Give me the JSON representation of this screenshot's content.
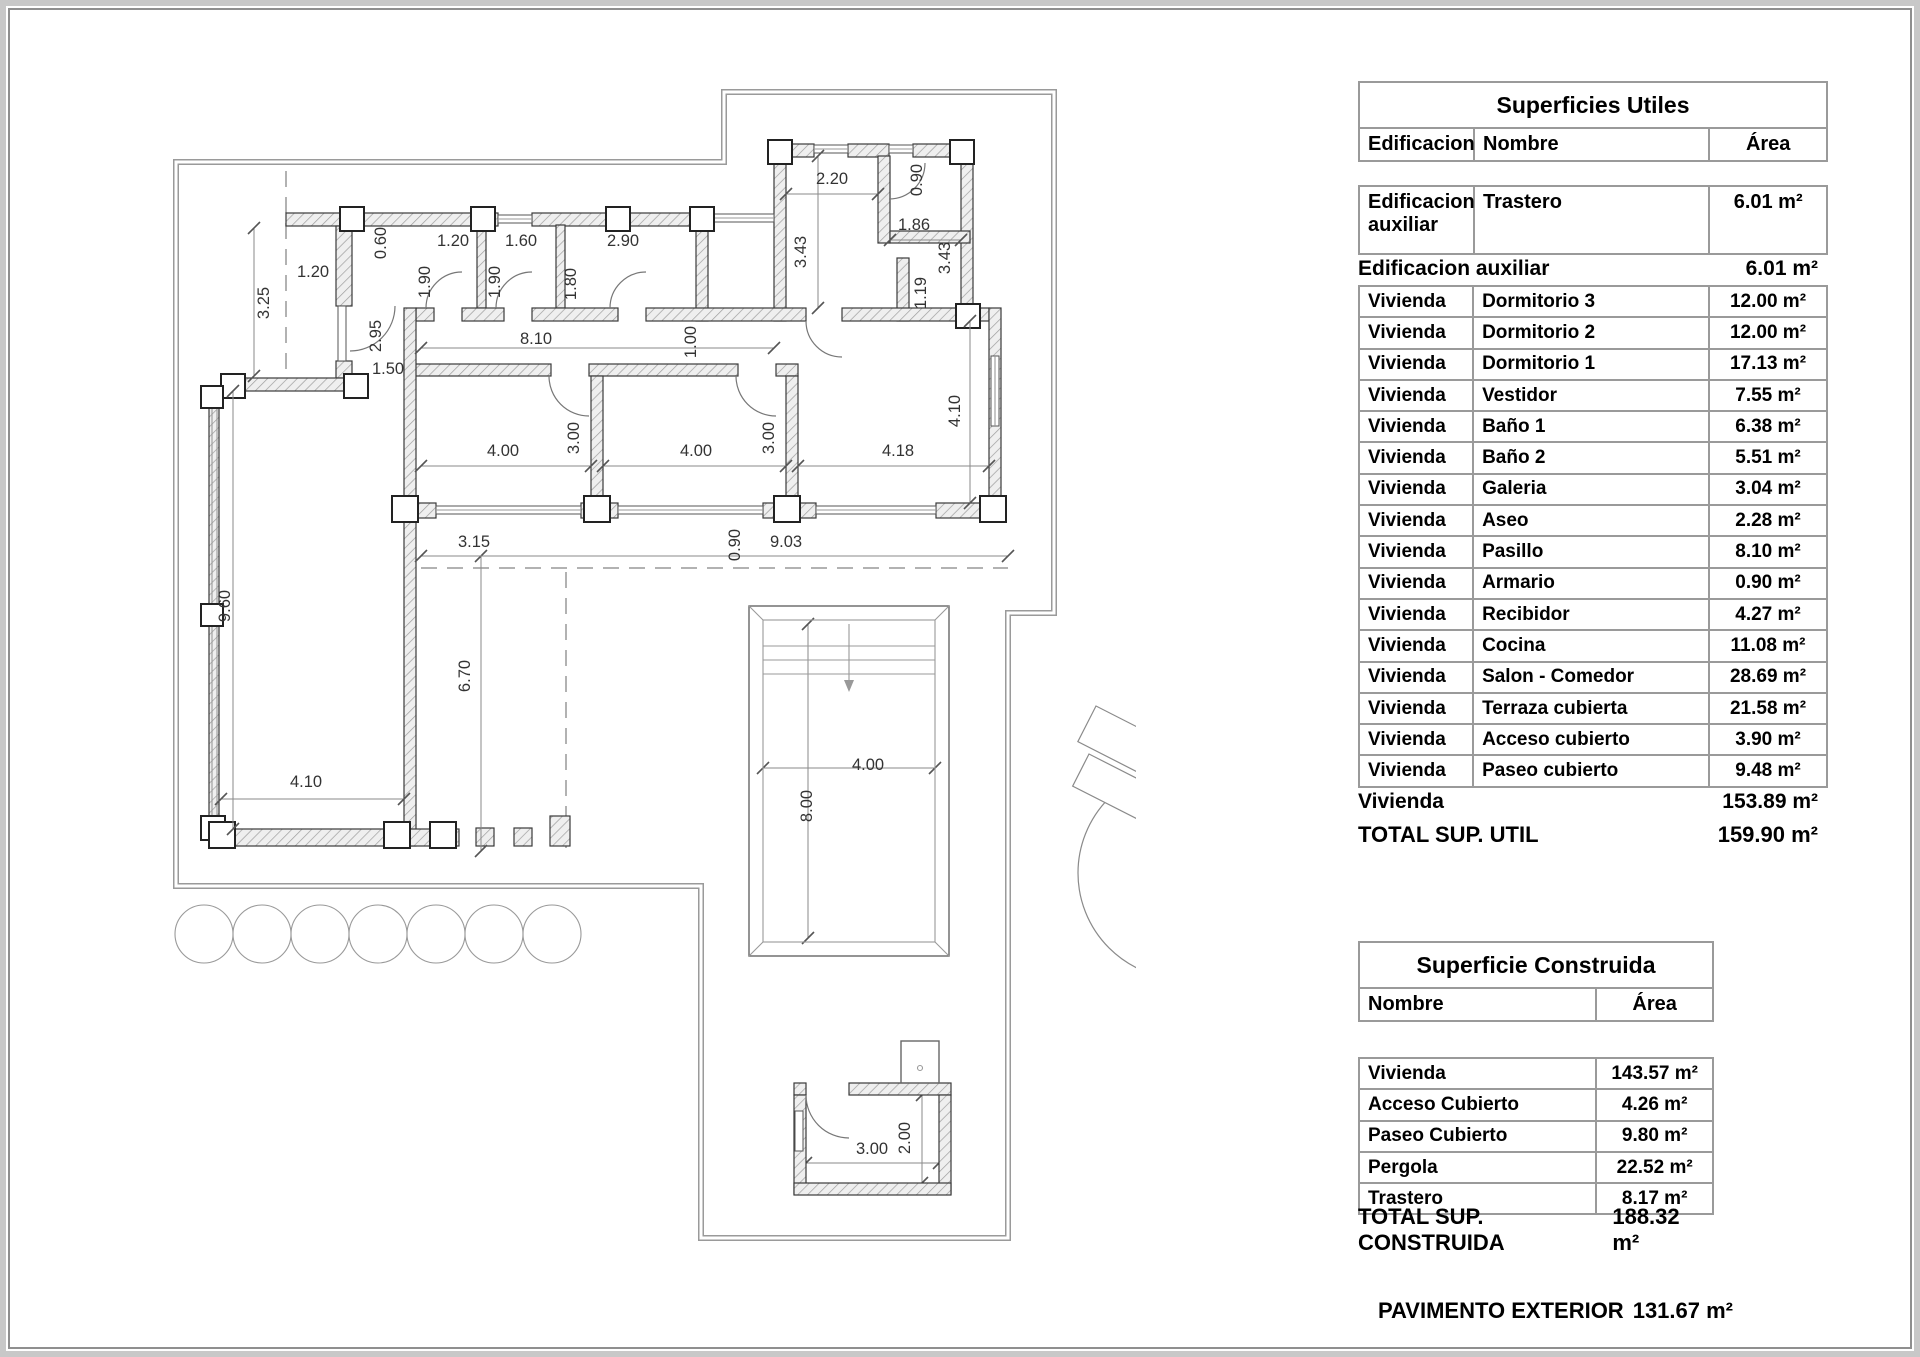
{
  "tables": {
    "utiles": {
      "title": "Superficies Utiles",
      "columns": {
        "edificacion": "Edificacion",
        "nombre": "Nombre",
        "area": "Área"
      },
      "aux_row": {
        "edificacion": "Edificacion auxiliar",
        "nombre": "Trastero",
        "area": "6.01 m²"
      },
      "aux_summary": {
        "label": "Edificacion auxiliar",
        "value": "6.01 m²"
      },
      "rows": [
        {
          "e": "Vivienda",
          "n": "Dormitorio 3",
          "a": "12.00 m²"
        },
        {
          "e": "Vivienda",
          "n": "Dormitorio 2",
          "a": "12.00 m²"
        },
        {
          "e": "Vivienda",
          "n": "Dormitorio 1",
          "a": "17.13 m²"
        },
        {
          "e": "Vivienda",
          "n": "Vestidor",
          "a": "7.55 m²"
        },
        {
          "e": "Vivienda",
          "n": "Baño 1",
          "a": "6.38 m²"
        },
        {
          "e": "Vivienda",
          "n": "Baño 2",
          "a": "5.51 m²"
        },
        {
          "e": "Vivienda",
          "n": "Galeria",
          "a": "3.04 m²"
        },
        {
          "e": "Vivienda",
          "n": "Aseo",
          "a": "2.28 m²"
        },
        {
          "e": "Vivienda",
          "n": "Pasillo",
          "a": "8.10 m²"
        },
        {
          "e": "Vivienda",
          "n": "Armario",
          "a": "0.90 m²"
        },
        {
          "e": "Vivienda",
          "n": "Recibidor",
          "a": "4.27 m²"
        },
        {
          "e": "Vivienda",
          "n": "Cocina",
          "a": "11.08 m²"
        },
        {
          "e": "Vivienda",
          "n": "Salon - Comedor",
          "a": "28.69 m²"
        },
        {
          "e": "Vivienda",
          "n": "Terraza cubierta",
          "a": "21.58 m²"
        },
        {
          "e": "Vivienda",
          "n": "Acceso cubierto",
          "a": "3.90 m²"
        },
        {
          "e": "Vivienda",
          "n": "Paseo cubierto",
          "a": "9.48 m²"
        }
      ],
      "vivienda_summary": {
        "label": "Vivienda",
        "value": "153.89 m²"
      },
      "total": {
        "label": "TOTAL SUP. UTIL",
        "value": "159.90 m²"
      }
    },
    "construida": {
      "title": "Superficie Construida",
      "columns": {
        "nombre": "Nombre",
        "area": "Área"
      },
      "rows": [
        {
          "n": "Vivienda",
          "a": "143.57 m²"
        },
        {
          "n": "Acceso Cubierto",
          "a": "4.26 m²"
        },
        {
          "n": "Paseo Cubierto",
          "a": "9.80 m²"
        },
        {
          "n": "Pergola",
          "a": "22.52 m²"
        },
        {
          "n": "Trastero",
          "a": "8.17 m²"
        }
      ],
      "total": {
        "label": "TOTAL SUP. CONSTRUIDA",
        "value": "188.32 m²"
      },
      "pavimento": {
        "label": "PAVIMENTO EXTERIOR",
        "value": "131.67 m²"
      }
    }
  },
  "plan": {
    "dims": [
      "3.25",
      "1.20",
      "0.60",
      "1.20",
      "1.90",
      "1.60",
      "1.90",
      "2.90",
      "1.80",
      "2.95",
      "1.50",
      "8.10",
      "1.00",
      "2.20",
      "0.90",
      "3.43",
      "1.86",
      "3.43",
      "1.19",
      "4.00",
      "3.00",
      "4.00",
      "3.00",
      "4.18",
      "4.10",
      "9.60",
      "4.10",
      "6.70",
      "3.15",
      "0.90",
      "9.03",
      "4.00",
      "8.00",
      "3.00",
      "2.00"
    ]
  }
}
